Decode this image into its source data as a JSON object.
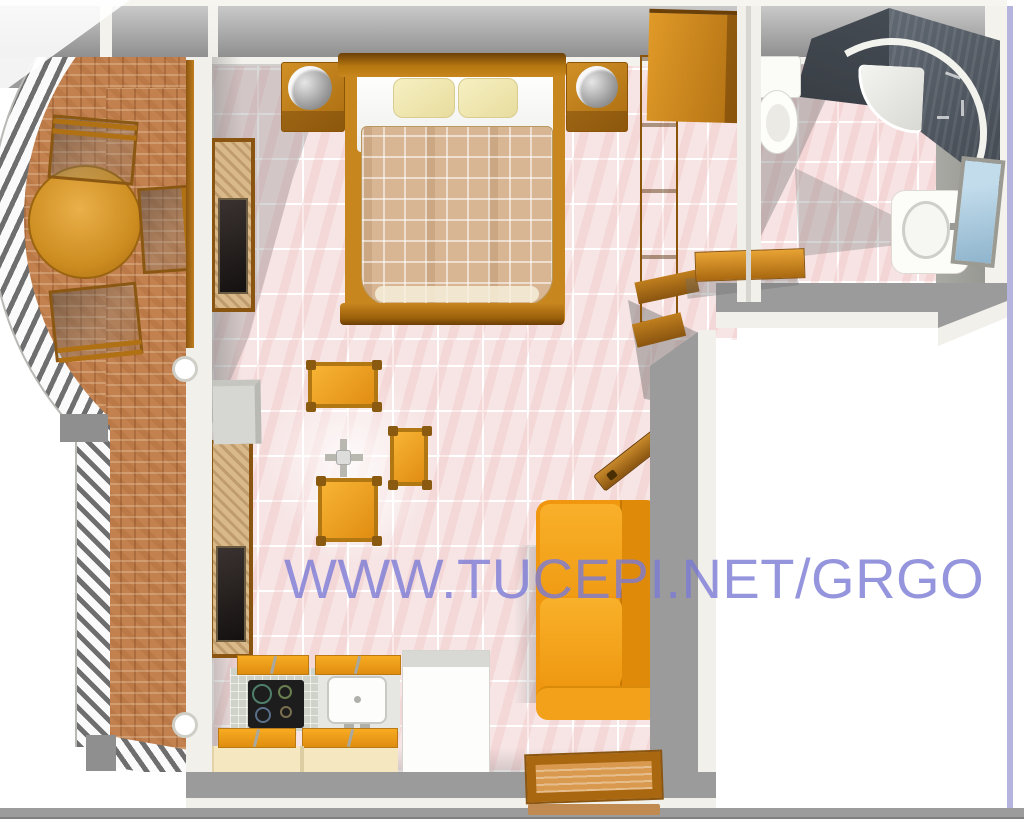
{
  "watermark": {
    "text": "WWW.TUCEPI.NET/GRGO",
    "color": "#7a7ad6"
  },
  "plan": {
    "type": "3d-floor-plan-top-view",
    "rooms": [
      {
        "name": "balcony",
        "floor": "brick-terracotta",
        "items": [
          "round-table",
          "chair",
          "chair",
          "chair",
          "curved-railing",
          "straight-railing",
          "wall-lamp",
          "wall-lamp"
        ]
      },
      {
        "name": "studio-room",
        "floor": "pink-tiles",
        "items": [
          "double-bed",
          "pillow",
          "pillow",
          "nightstand-left",
          "nightstand-right",
          "lamp",
          "lamp",
          "wardrobe",
          "shelf-column",
          "tv-unit",
          "tv-unit",
          "gray-appliance",
          "dining-stool",
          "dining-stool",
          "dining-stool",
          "cross-table",
          "kitchen-cooktop",
          "kitchen-sink",
          "kitchen-appliance",
          "kitchen-cabinets",
          "sofa",
          "white-door",
          "entry-door",
          "doormat"
        ]
      },
      {
        "name": "bathroom",
        "floor": "pink-tiles",
        "items": [
          "corner-shower",
          "toilet",
          "washbasin",
          "mirror",
          "bench-shelf"
        ]
      }
    ],
    "palette": {
      "wall_gray": "#9b9b9b",
      "wall_lining": "#f2f0ea",
      "tile_pink": "#f7e5e5",
      "brick": "#c2814f",
      "wood_orange": "#c8861e",
      "sofa_orange": "#f0970f",
      "stool_orange": "#f0a020",
      "pillow_cream": "#f0ecc0",
      "blanket_tan": "#d8b694",
      "shower_dark": "#40474f",
      "mirror_blue": "#a9cadf",
      "border_lavender": "#b4b4de"
    }
  }
}
